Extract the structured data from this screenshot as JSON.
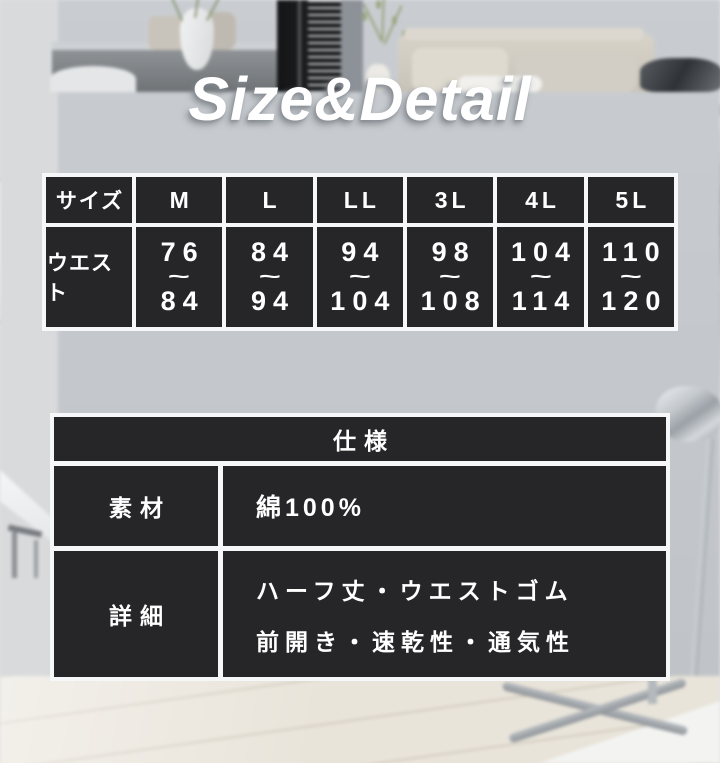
{
  "title": {
    "text": "Size&Detail"
  },
  "size_table": {
    "corner_label": "サイズ",
    "row_label": "ウエスト",
    "tilde": "~",
    "columns": [
      {
        "size": "M",
        "from": "76",
        "to": "84"
      },
      {
        "size": "L",
        "from": "84",
        "to": "94"
      },
      {
        "size": "LL",
        "from": "94",
        "to": "104"
      },
      {
        "size": "3L",
        "from": "98",
        "to": "108"
      },
      {
        "size": "4L",
        "from": "104",
        "to": "114"
      },
      {
        "size": "5L",
        "from": "110",
        "to": "120"
      }
    ]
  },
  "spec_table": {
    "header": "仕様",
    "rows": [
      {
        "label": "素材",
        "lines": [
          "綿100%"
        ]
      },
      {
        "label": "詳細",
        "lines": [
          "ハーフ丈・ウエストゴム",
          "前開き・速乾性・通気性"
        ]
      }
    ]
  },
  "colors": {
    "cell_background": "#1b1c1e",
    "cell_divider": "#f6f7f8",
    "table_text": "#ffffff",
    "title_text": "#ffffff"
  }
}
